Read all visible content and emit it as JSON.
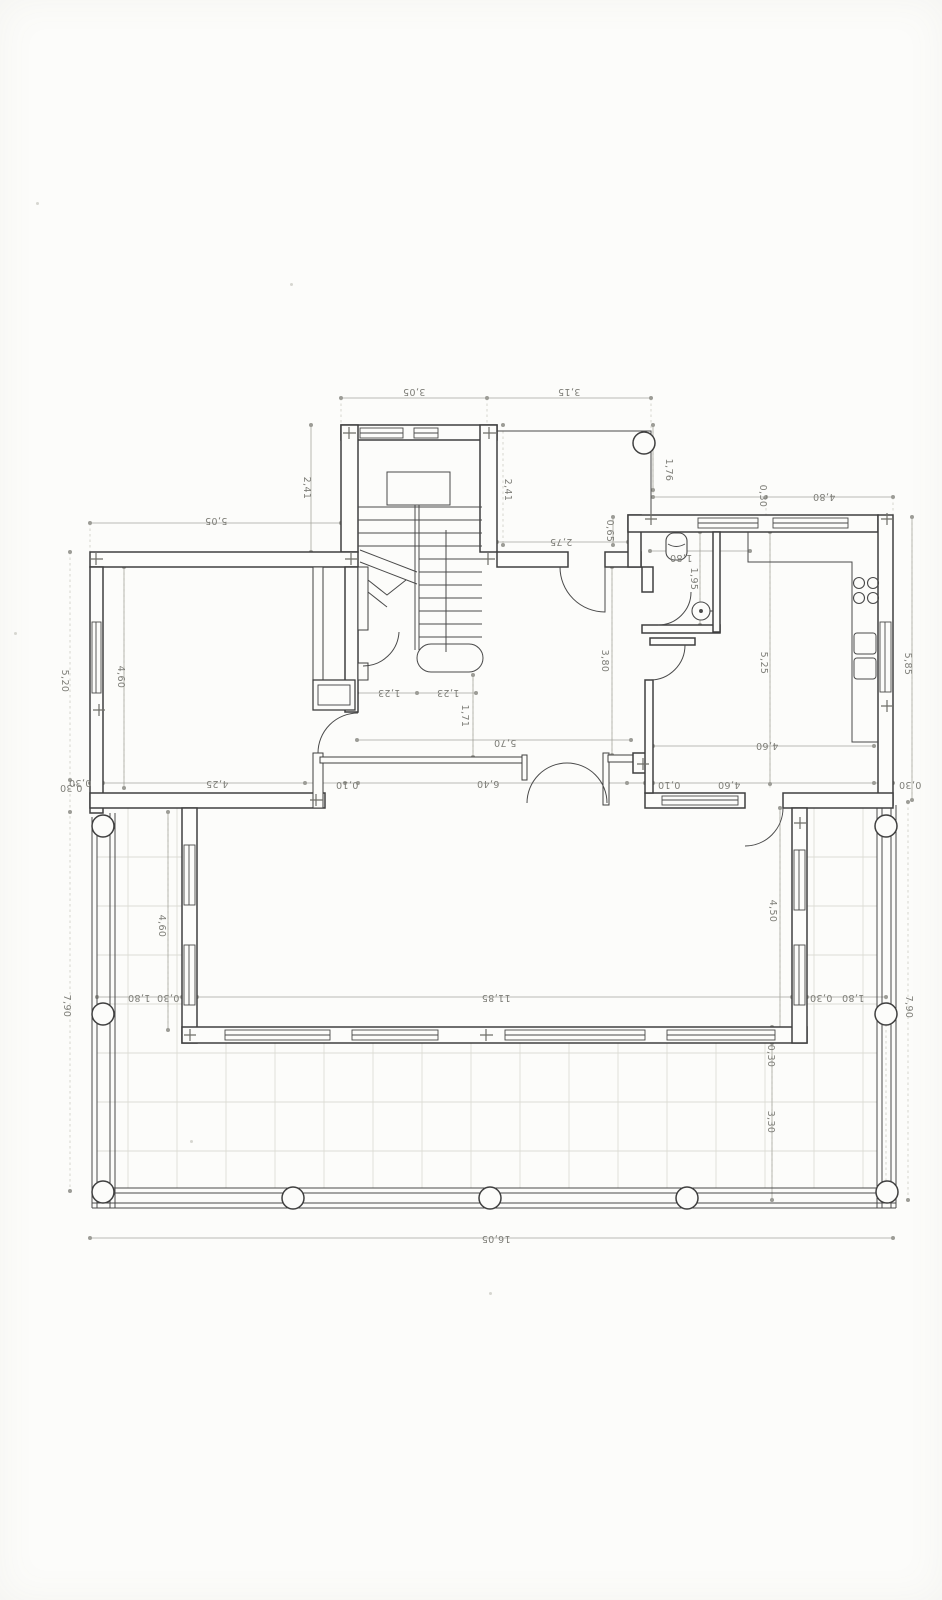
{
  "drawing": {
    "kind": "scanned architectural floor plan, ground floor with stair, WC, kitchen, living room and wrap-around terrace with balustrade columns",
    "units": "meters",
    "paper_color": "#fcfcfa",
    "wall_line_color": "#3f3f3f",
    "dimension_line_color": "#a5a59e",
    "dimension_text_color": "#7e7e78",
    "tile_grid_color": "#dcdcd5"
  },
  "dims": {
    "stair_top": "3,05",
    "porch_top": "3,15",
    "stair_left": "2,41",
    "porch_left": "2,41",
    "porch_right": "1,76",
    "ne_offset": "0,30",
    "ne_top": "4,80",
    "jog": "0,65",
    "hall_top": "2,75",
    "nw_top": "5,05",
    "west_upper": "5,20",
    "west_wall": "0,30",
    "west_lower": "7,90",
    "left_room_height": "4,60",
    "mid_a": "0,30",
    "mid_b": "4,25",
    "mid_c": "0,10",
    "flight_a": "1,23",
    "flight_b": "1,23",
    "newel": "1,71",
    "hall_width": "5,70",
    "hall_height": "3,80",
    "mid_d": "6,40",
    "mid_e": "0,10",
    "mid_f": "4,60",
    "mid_g": "0,30",
    "wc_width": "1,80",
    "wc_height": "1,95",
    "kitchen_height": "5,25",
    "east_upper": "5,85",
    "dining_width": "4,60",
    "bigroom_left": "4,60",
    "bigroom_right": "4,50",
    "terrace_left_a": "1,80",
    "terrace_left_b": "0,30",
    "bigroom_width": "11,85",
    "terrace_right_a": "0,30",
    "terrace_right_b": "1,80",
    "south_wall": "0,30",
    "terrace_south": "3,30",
    "east_lower": "7,90",
    "total_width": "16,05"
  }
}
